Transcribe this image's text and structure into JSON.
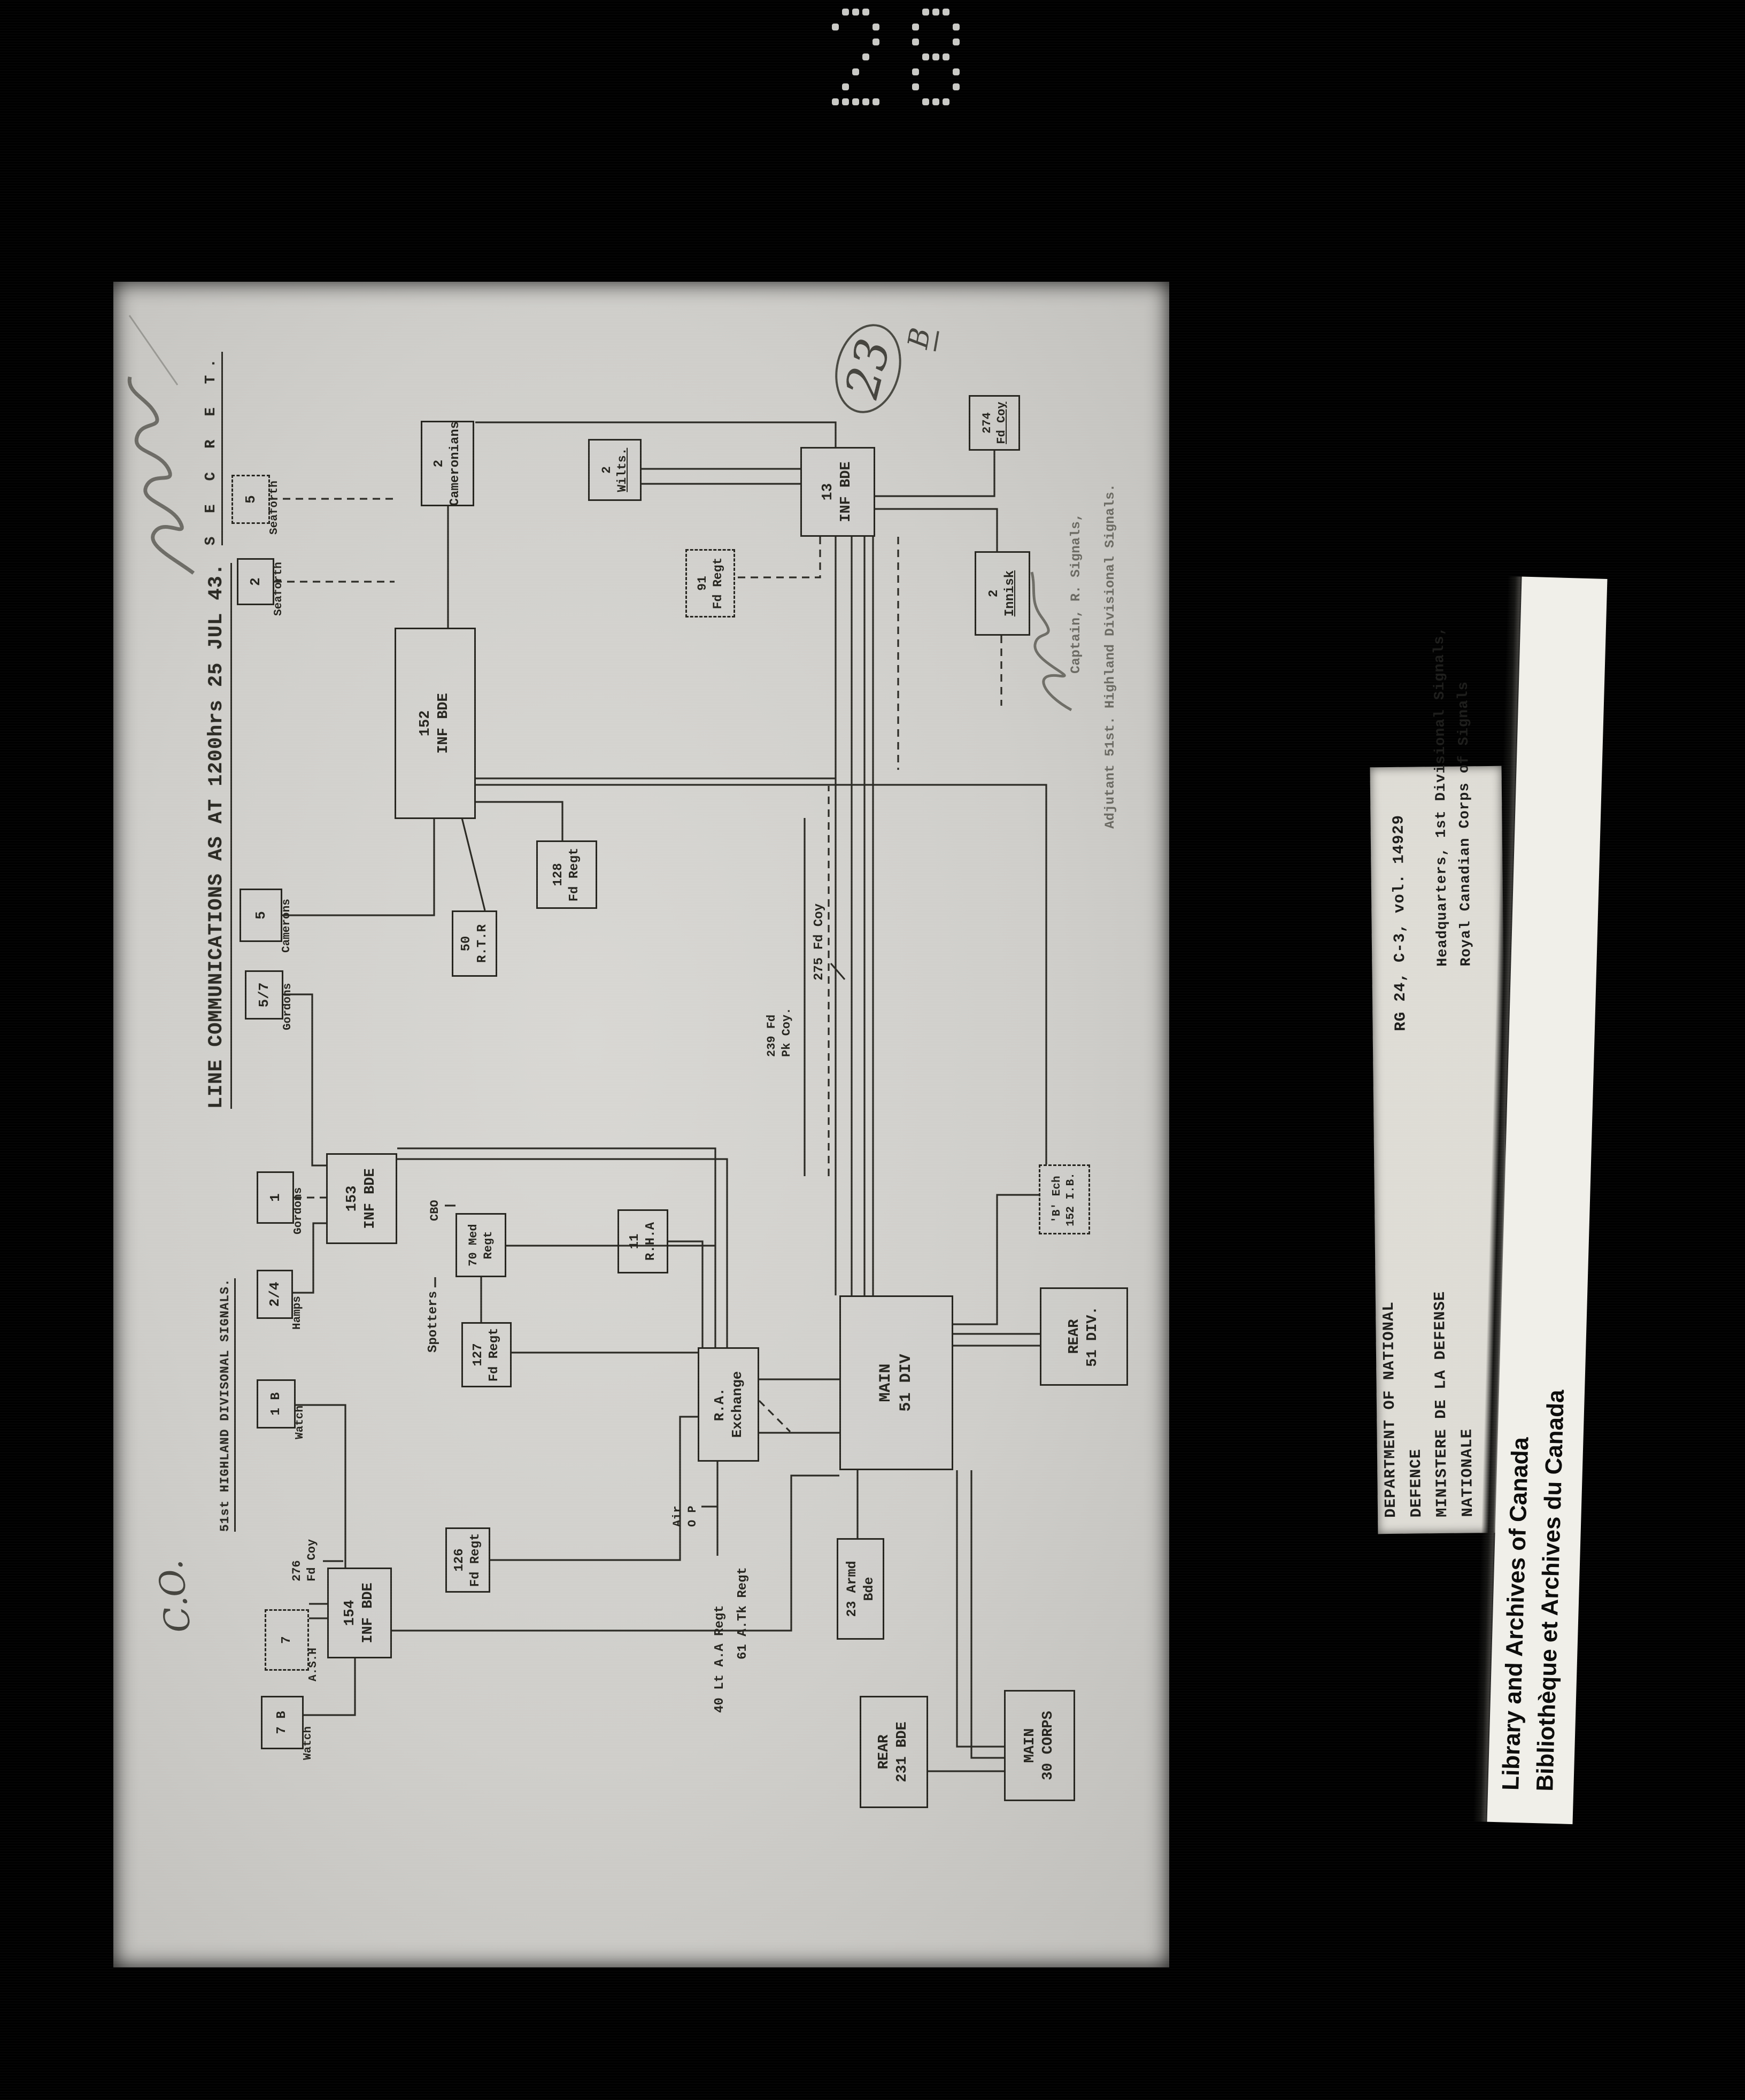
{
  "frame": {
    "photo_number": "28"
  },
  "captions": {
    "department_lines": [
      "DEPARTMENT OF NATIONAL",
      "DEFENCE",
      "MINISTERE DE LA DEFENSE",
      "NATIONALE"
    ],
    "reference": "RG 24, C-3, vol. 14929",
    "hq_line1": "Headquarters, 1st Divisional Signals,",
    "hq_line2": "Royal Canadian Corps of Signals",
    "lac_en": "Library and Archives of Canada",
    "lac_fr": "Bibliothèque et Archives du Canada"
  },
  "document": {
    "classification": "S E C R E T.",
    "heading": "51st HIGHLAND DIVISONAL SIGNALS.",
    "title": "LINE COMMUNICATIONS AS AT 1200hrs 25 JUL 43.",
    "annotations": {
      "co": "C.O.",
      "page_number": "23",
      "page_letter": "B"
    },
    "signature_line1": "Captain, R. Signals,",
    "signature_line2": "Adjutant 51st. Highland Divisional Signals.",
    "nodes": [
      {
        "id": "n_5sea",
        "lines": [
          "5"
        ],
        "label": "Seaforth"
      },
      {
        "id": "n_2sea",
        "lines": [
          "2"
        ],
        "label": "Seaforth"
      },
      {
        "id": "n_5cam",
        "lines": [
          "5"
        ],
        "label": "Camerons"
      },
      {
        "id": "n_57gor",
        "lines": [
          "5/7"
        ],
        "label": "Gordons"
      },
      {
        "id": "n_1gor",
        "lines": [
          "1"
        ],
        "label": "Gordons"
      },
      {
        "id": "n_24ham",
        "lines": [
          "2/4"
        ],
        "label": "Hamps"
      },
      {
        "id": "n_1bw",
        "lines": [
          "1 B"
        ],
        "label": "Watch"
      },
      {
        "id": "n_7ash",
        "lines": [
          "7"
        ],
        "label": "A.S.H"
      },
      {
        "id": "n_7bw",
        "lines": [
          "7 B"
        ],
        "label": "Watch"
      },
      {
        "id": "n_154",
        "lines": [
          "154",
          "INF BDE"
        ]
      },
      {
        "id": "n_153",
        "lines": [
          "153",
          "INF BDE"
        ]
      },
      {
        "id": "n_152",
        "lines": [
          "152",
          "INF BDE"
        ]
      },
      {
        "id": "n_13",
        "lines": [
          "13",
          "INF BDE"
        ]
      },
      {
        "id": "n_2cam",
        "lines": [
          "2",
          "Cameronians"
        ]
      },
      {
        "id": "n_2wil",
        "lines": [
          "2",
          "Wilts."
        ]
      },
      {
        "id": "n_91fd",
        "lines": [
          "91",
          "Fd Regt"
        ]
      },
      {
        "id": "n_2inn",
        "lines": [
          "2",
          "Innisk"
        ]
      },
      {
        "id": "n_274",
        "lines": [
          "274",
          "Fd Coy"
        ]
      },
      {
        "id": "n_50rtr",
        "lines": [
          "50",
          "R.T.R"
        ]
      },
      {
        "id": "n_128",
        "lines": [
          "128",
          "Fd Regt"
        ]
      },
      {
        "id": "n_70med",
        "lines": [
          "70 Med",
          "Regt"
        ]
      },
      {
        "id": "n_127",
        "lines": [
          "127",
          "Fd Regt"
        ]
      },
      {
        "id": "n_126",
        "lines": [
          "126",
          "Fd Regt"
        ]
      },
      {
        "id": "n_11rha",
        "lines": [
          "11",
          "R.H.A"
        ]
      },
      {
        "id": "n_raex",
        "lines": [
          "R.A.",
          "Exchange"
        ]
      },
      {
        "id": "n_main51",
        "lines": [
          "MAIN",
          "51 DIV"
        ]
      },
      {
        "id": "n_rear51",
        "lines": [
          "REAR",
          "51 DIV."
        ]
      },
      {
        "id": "n_bech",
        "lines": [
          "'B' Ech",
          "152 I.B."
        ]
      },
      {
        "id": "n_23armd",
        "lines": [
          "23 Armd",
          "Bde"
        ]
      },
      {
        "id": "n_rear231",
        "lines": [
          "REAR",
          "231 BDE"
        ]
      },
      {
        "id": "n_main30",
        "lines": [
          "MAIN",
          "30 CORPS"
        ]
      }
    ],
    "labels": [
      {
        "id": "l_spot",
        "lines": [
          "Spotters"
        ]
      },
      {
        "id": "l_cbo",
        "lines": [
          "CBO"
        ]
      },
      {
        "id": "l_276",
        "lines": [
          "276",
          "Fd Coy"
        ]
      },
      {
        "id": "l_275",
        "lines": [
          "275 Fd Coy"
        ]
      },
      {
        "id": "l_239",
        "lines": [
          "239 Fd",
          "Pk Coy."
        ]
      },
      {
        "id": "l_airop",
        "lines": [
          "Air",
          "O P"
        ]
      },
      {
        "id": "l_40",
        "lines": [
          "40 Lt A.A Regt"
        ]
      },
      {
        "id": "l_61",
        "lines": [
          "61 A.Tk Regt"
        ]
      }
    ]
  },
  "ink": {
    "line_color": "#2b2a24"
  }
}
